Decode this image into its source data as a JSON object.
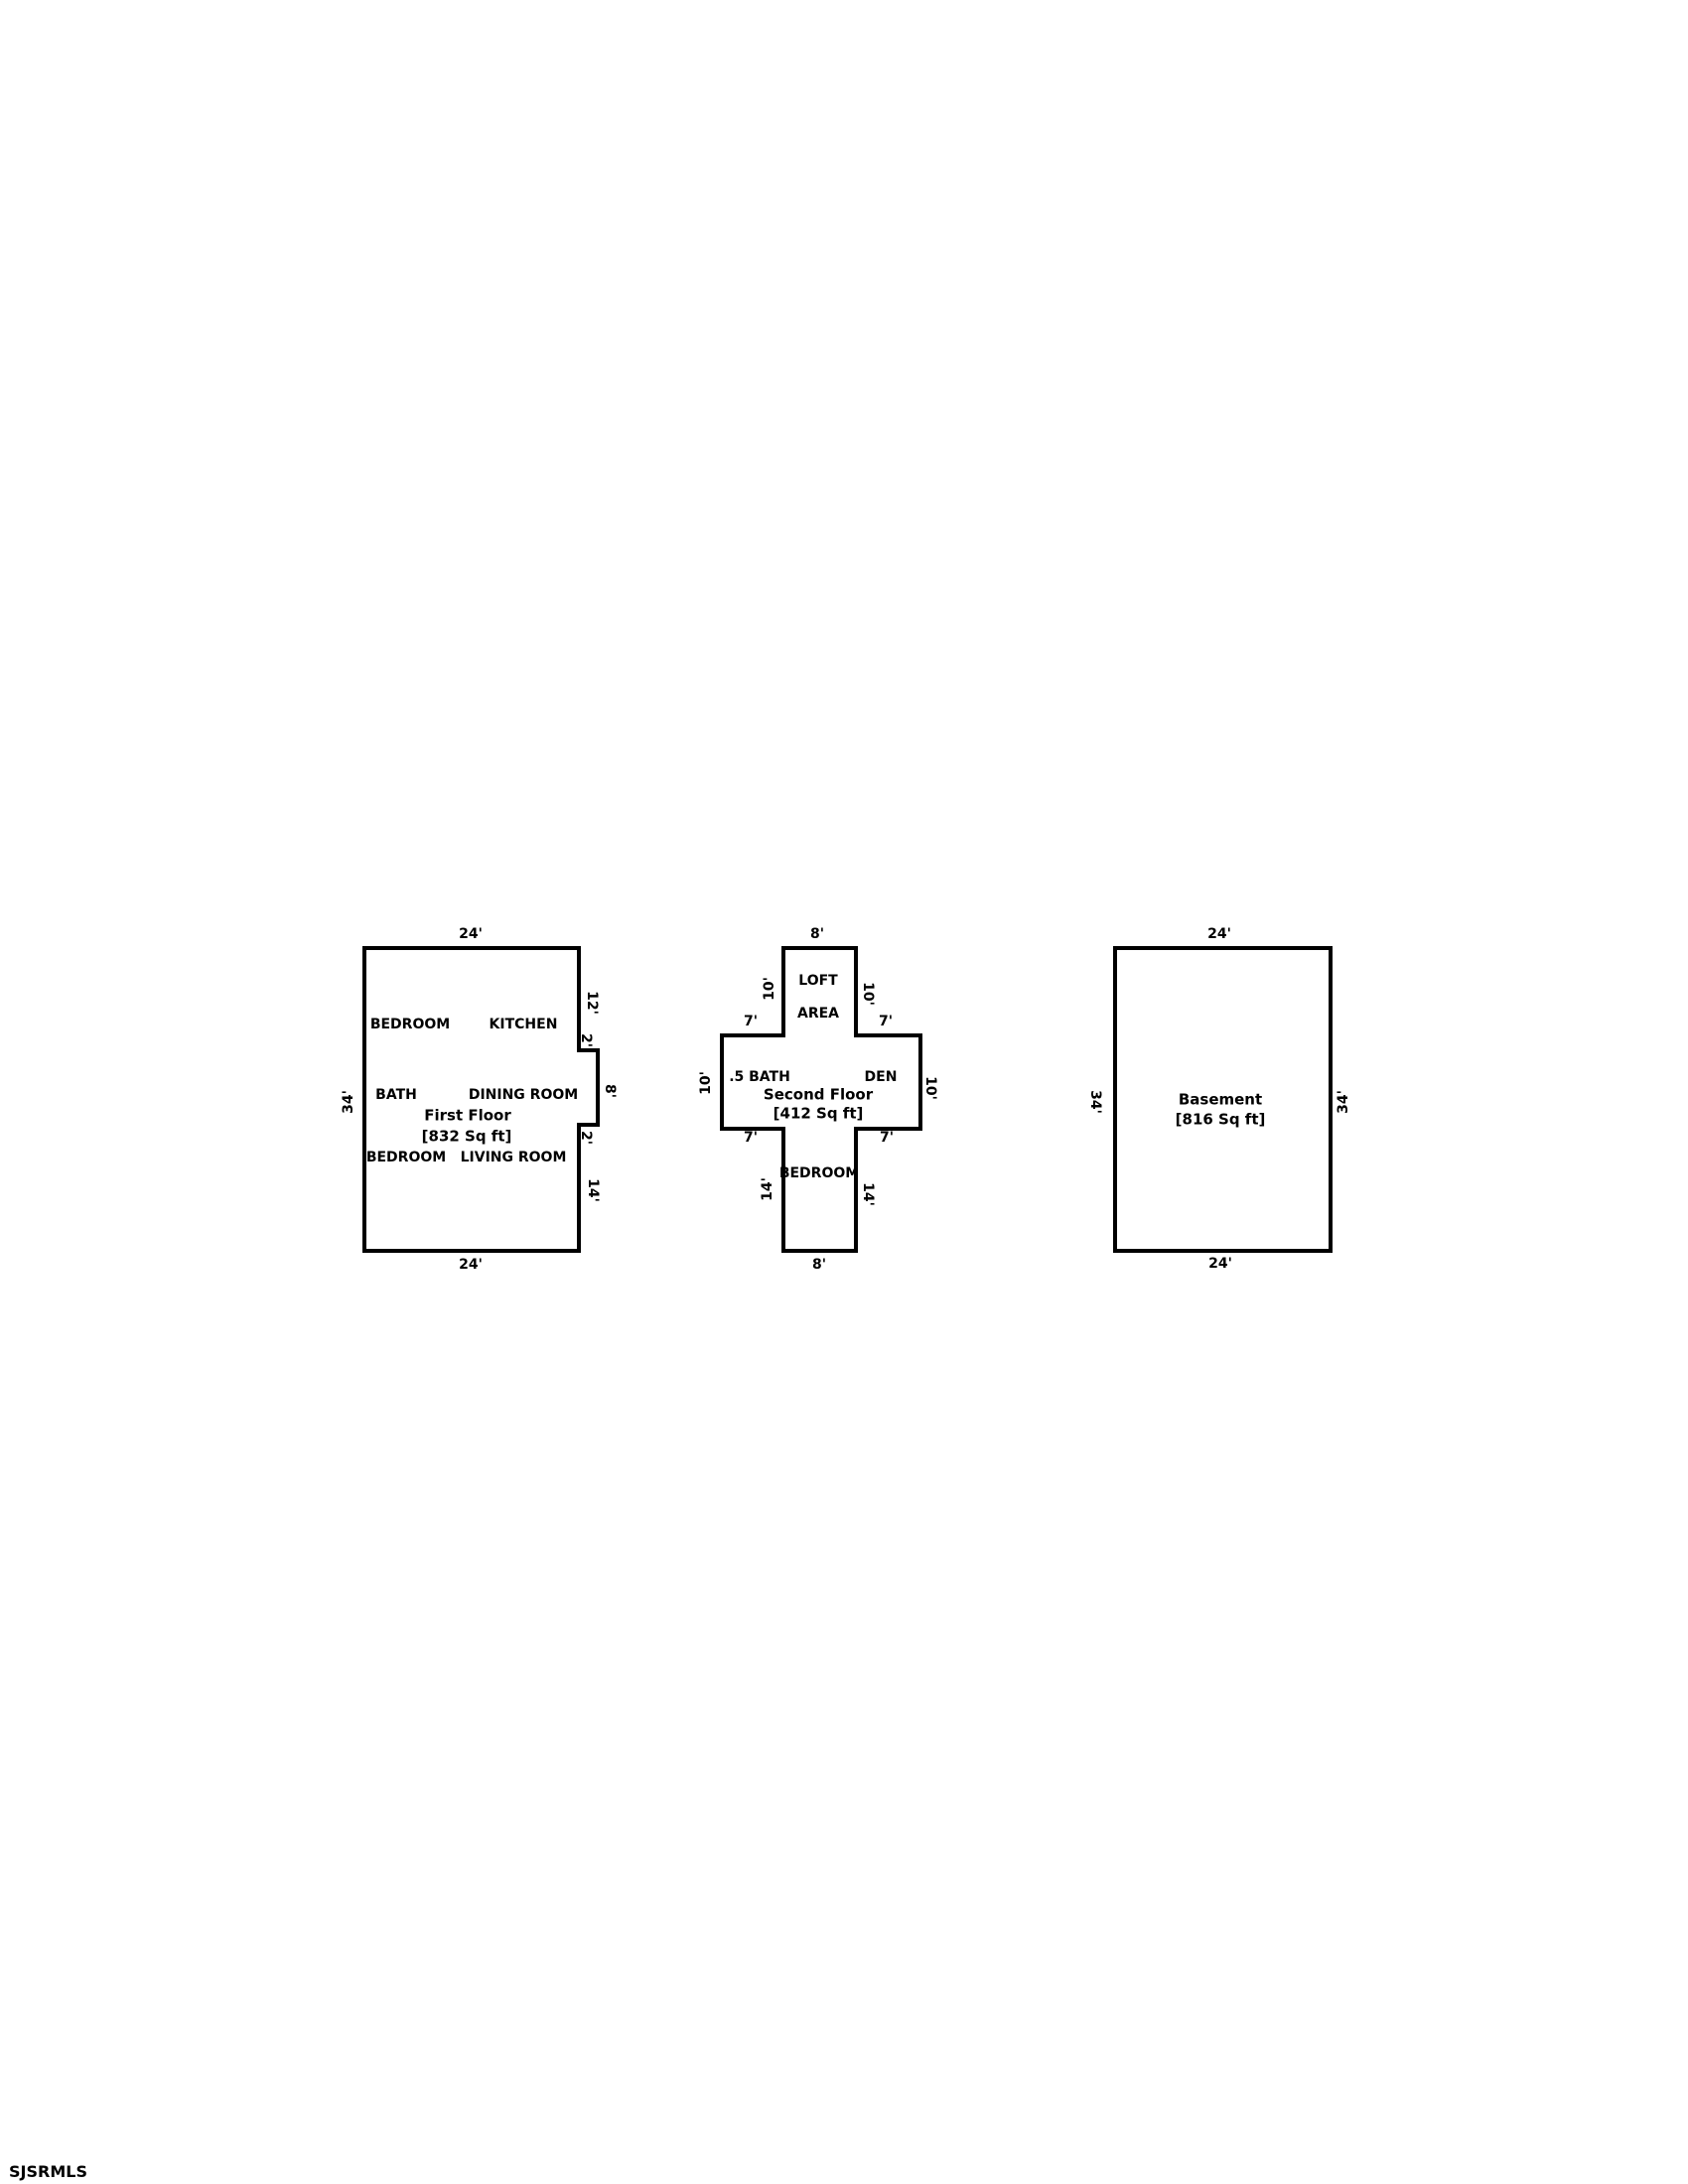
{
  "watermark": "SJSRMLS",
  "plans": {
    "first": {
      "title": "First Floor",
      "area": "[832 Sq ft]",
      "rooms": {
        "bedroom1": "BEDROOM",
        "kitchen": "KITCHEN",
        "bath": "BATH",
        "dining": "DINING ROOM",
        "bedroom2": "BEDROOM",
        "living": "LIVING ROOM"
      },
      "dims": {
        "top": "24'",
        "bottom": "24'",
        "left": "34'",
        "right_upper": "12'",
        "jog_upper": "2'",
        "bump": "8'",
        "jog_lower": "2'",
        "right_lower": "14'"
      }
    },
    "second": {
      "title": "Second Floor",
      "area": "[412 Sq ft]",
      "rooms": {
        "loft_line1": "LOFT",
        "loft_line2": "AREA",
        "half_bath": ".5 BATH",
        "den": "DEN",
        "bedroom": "BEDROOM"
      },
      "dims": {
        "top": "8'",
        "bottom": "8'",
        "top_arm_left": "10'",
        "top_arm_right": "10'",
        "shoulder_left": "7'",
        "shoulder_right": "7'",
        "mid_left": "10'",
        "mid_right": "10'",
        "hip_left": "7'",
        "hip_right": "7'",
        "bottom_arm_left": "14'",
        "bottom_arm_right": "14'"
      }
    },
    "basement": {
      "title": "Basement",
      "area": "[816 Sq ft]",
      "dims": {
        "top": "24'",
        "bottom": "24'",
        "left": "34'",
        "right": "34'"
      }
    }
  },
  "colors": {
    "wall": "#000000",
    "background": "#ffffff",
    "text": "#000000"
  }
}
